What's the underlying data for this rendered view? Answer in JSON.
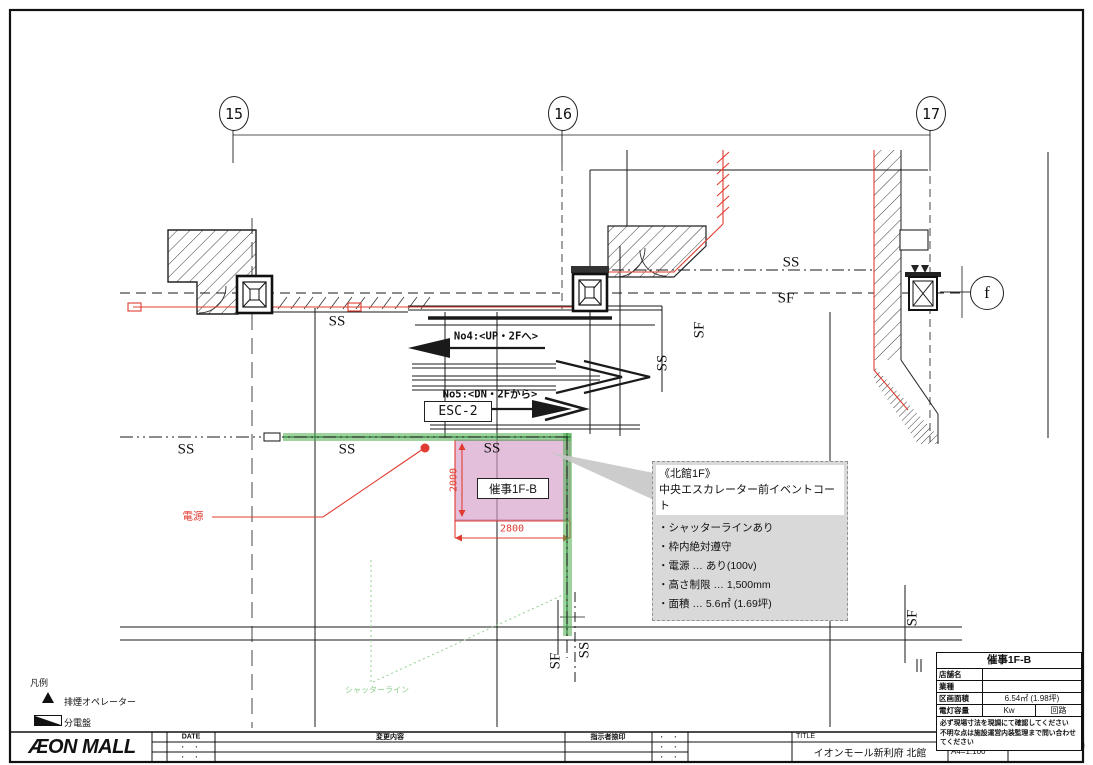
{
  "colors": {
    "red": "#e03c31",
    "green": "#4fae4f",
    "green_text": "#8fcf8f",
    "pink": "#d59cc7",
    "note_gray": "#d9d9d9",
    "line": "#1a1a1a"
  },
  "grid": {
    "bubbles": [
      "15",
      "16",
      "17",
      "f"
    ]
  },
  "plan": {
    "ss": "SS",
    "sf": "SF",
    "esc_box": "ESC-2",
    "esc_up": "No4:<UP・2Fへ>",
    "esc_down": "No5:<DN・2Fから>",
    "event_area": "催事1F-B",
    "dim_v": "2000",
    "dim_h": "2800",
    "power": "電源",
    "shutter_line": "シャッターライン"
  },
  "notes": {
    "heading1": "《北館1F》",
    "heading2": "中央エスカレーター前イベントコート",
    "items": [
      "・シャッターラインあり",
      "・枠内絶対遵守",
      "・電源 … あり(100v)",
      "・高さ制限 … 1,500mm",
      "・面積 … 5.6㎡ (1.69坪)"
    ]
  },
  "legend": {
    "title": "凡例",
    "item1": "排煙オペレーター",
    "item2": "分電盤"
  },
  "logo": {
    "text": "ÆON MALL"
  },
  "revision": {
    "date": "DATE",
    "change": "変更内容",
    "approver": "指示者捺印",
    "dots": "・ ・"
  },
  "titleblock": {
    "title_label": "TITLE",
    "title": "イオンモール新利府 北館",
    "scale_label": "SCALE",
    "scale": "A4=1:100",
    "date": "2021.07.30"
  },
  "spec": {
    "header": "催事1F-B",
    "row1_label": "店舗名",
    "row1_value": "",
    "row2_label": "業種",
    "row2_value": "",
    "row3_label": "区画面積",
    "row3_value": "6.54㎡ (1.98坪)",
    "row4_label": "電灯容量",
    "row4_value": "Kw",
    "row4_value2": "回路",
    "warning1": "必ず現場寸法を現調にて確認してください",
    "warning2": "不明な点は施設運営内装監理まで問い合わせてください"
  }
}
